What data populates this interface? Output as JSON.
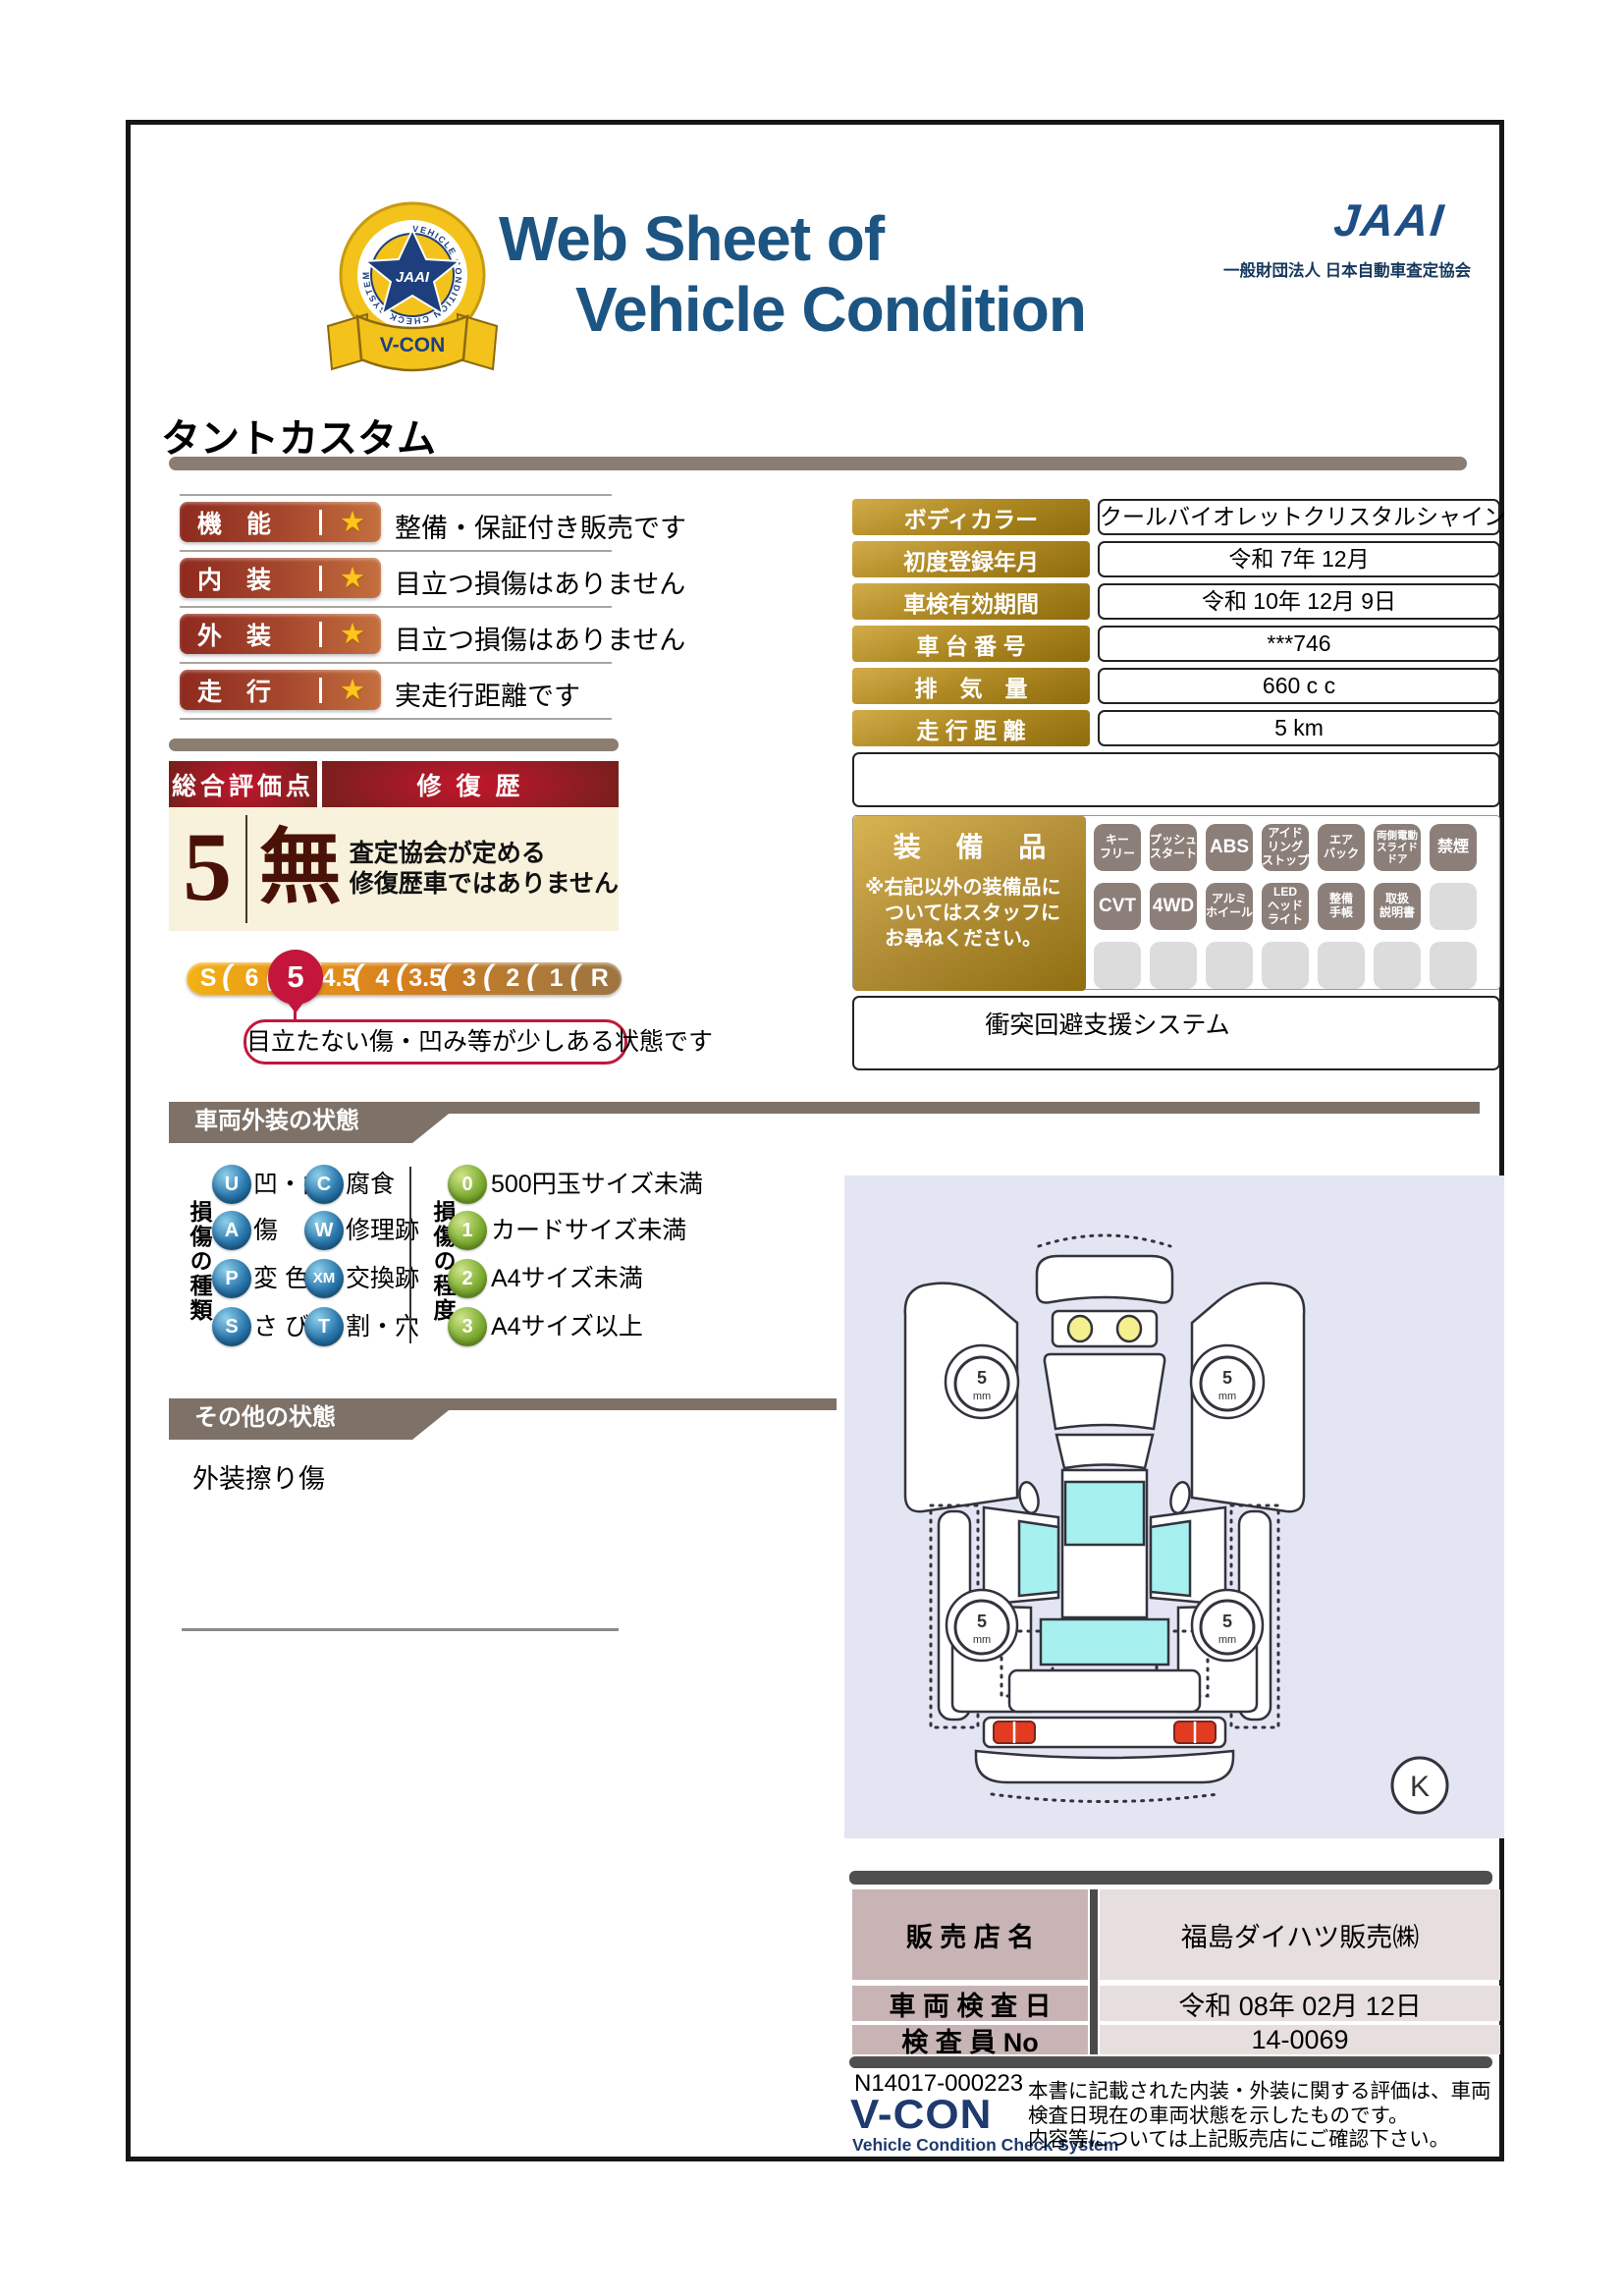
{
  "header": {
    "title_line1": "Web Sheet of",
    "title_line2": "Vehicle Condition",
    "jaai_wordmark": "JAAI",
    "jaai_subtitle": "一般財団法人 日本自動車査定協会",
    "badge": {
      "ring_text": "VEHICLE CONDITION CHECK SYSTEM",
      "star_text": "JAAI",
      "ribbon": "V-CON"
    }
  },
  "vehicle_name": "タントカスタム",
  "ratings": [
    {
      "label": "機　能",
      "desc": "整備・保証付き販売です"
    },
    {
      "label": "内　装",
      "desc": "目立つ損傷はありません"
    },
    {
      "label": "外　装",
      "desc": "目立つ損傷はありません"
    },
    {
      "label": "走　行",
      "desc": "実走行距離です"
    }
  ],
  "overall": {
    "score_header": "総合評価点",
    "repair_header": "修 復 歴",
    "score": "5",
    "repair_value": "無",
    "repair_note1": "査定協会が定める",
    "repair_note2": "修復歴車ではありません",
    "scale": [
      "S",
      "6",
      "5",
      "4.5",
      "4",
      "3.5",
      "3",
      "2",
      "1",
      "R"
    ],
    "selected_score": "5",
    "score_note": "目立たない傷・凹み等が少しある状態です"
  },
  "info": {
    "rows": [
      {
        "label": "ボディカラー",
        "value": "クールバイオレットクリスタルシャイン"
      },
      {
        "label": "初度登録年月",
        "value": "令和 7年 12月"
      },
      {
        "label": "車検有効期間",
        "value": "令和 10年 12月 9日"
      },
      {
        "label": "車 台 番 号",
        "value": "***746"
      },
      {
        "label": "排　気　量",
        "value": "660 c c"
      },
      {
        "label": "走 行 距 離",
        "value": "5 km"
      }
    ]
  },
  "equipment": {
    "title": "装 備 品",
    "note1": "※右記以外の装備品に",
    "note2": "ついてはスタッフに",
    "note3": "お尋ねください。",
    "badges": [
      {
        "label": "キー\nフリー"
      },
      {
        "label": "プッシュ\nスタート"
      },
      {
        "label": "ABS"
      },
      {
        "label": "アイド\nリング\nストップ"
      },
      {
        "label": "エア\nバック"
      },
      {
        "label": "両側電動\nスライド\nドア"
      },
      {
        "label": "禁煙"
      },
      {
        "label": "CVT"
      },
      {
        "label": "4WD"
      },
      {
        "label": "アルミ\nホイール"
      },
      {
        "label": "LED\nヘッド\nライト"
      },
      {
        "label": "整備\n手帳"
      },
      {
        "label": "取扱\n説明書"
      },
      {
        "label": ""
      },
      {
        "label": ""
      },
      {
        "label": ""
      },
      {
        "label": ""
      },
      {
        "label": ""
      },
      {
        "label": ""
      },
      {
        "label": ""
      },
      {
        "label": ""
      }
    ],
    "safety_note": "衝突回避支援システム"
  },
  "exterior": {
    "section_title": "車両外装の状態",
    "type_axis": "損傷の種類",
    "degree_axis": "損傷の程度",
    "types_col1": [
      {
        "code": "U",
        "text": "凹・曲"
      },
      {
        "code": "A",
        "text": "傷"
      },
      {
        "code": "P",
        "text": "変 色"
      },
      {
        "code": "S",
        "text": "さ び"
      }
    ],
    "types_col2": [
      {
        "code": "C",
        "text": "腐食"
      },
      {
        "code": "W",
        "text": "修理跡"
      },
      {
        "code": "XM",
        "text": "交換跡"
      },
      {
        "code": "T",
        "text": "割・穴"
      }
    ],
    "degrees": [
      {
        "code": "0",
        "text": "500円玉サイズ未満"
      },
      {
        "code": "1",
        "text": "カードサイズ未満"
      },
      {
        "code": "2",
        "text": "A4サイズ未満"
      },
      {
        "code": "3",
        "text": "A4サイズ以上"
      }
    ]
  },
  "other": {
    "section_title": "その他の状態",
    "note": "外装擦り傷"
  },
  "diagram": {
    "tire_value": "5",
    "tire_unit": "mm",
    "corner_mark": "K"
  },
  "dealer": {
    "rows": [
      {
        "label": "販 売 店 名",
        "value": "福島ダイハツ販売㈱"
      },
      {
        "label": "車 両 検 査 日",
        "value": "令和 08年 02月 12日"
      },
      {
        "label": "検 査 員 No",
        "value": "14-0069"
      }
    ]
  },
  "footer": {
    "doc_no": "N14017-000223",
    "vcon": "V-CON",
    "vcon_sub": "Vehicle Condition Check System",
    "disclaimer1": "本書に記載された内装・外装に関する評価は、車両",
    "disclaimer2": "検査日現在の車両状態を示したものです。",
    "disclaimer3": "内容等については上記販売店にご確認下さい。"
  }
}
